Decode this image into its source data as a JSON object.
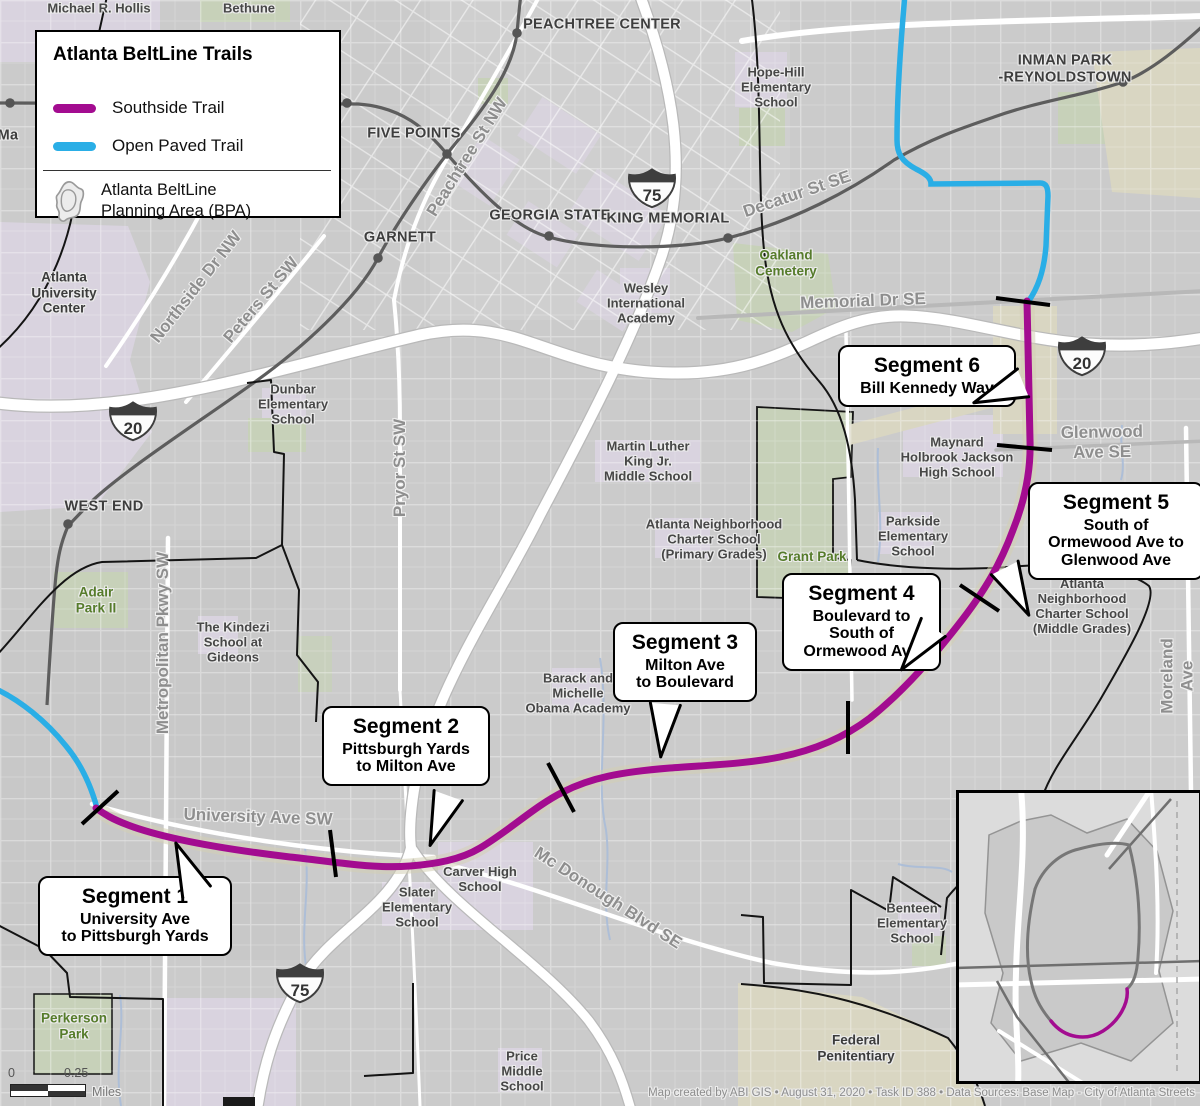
{
  "legend": {
    "title": "Atlanta BeltLine Trails",
    "items": [
      {
        "label": "Southside Trail",
        "color": "#a30c90"
      },
      {
        "label": "Open Paved Trail",
        "color": "#2aaee6"
      }
    ],
    "bpa_label": "Atlanta BeltLine\nPlanning Area (BPA)",
    "bpa_icon": "beltline-planning-area-outline-icon"
  },
  "callouts": [
    {
      "title": "Segment 1",
      "body": "University Ave\nto Pittsburgh Yards"
    },
    {
      "title": "Segment 2",
      "body": "Pittsburgh Yards\nto Milton Ave"
    },
    {
      "title": "Segment 3",
      "body": "Milton Ave\nto Boulevard"
    },
    {
      "title": "Segment 4",
      "body": "Boulevard to\nSouth of\nOrmewood Ave"
    },
    {
      "title": "Segment 5",
      "body": "South of\nOrmewood Ave to\nGlenwood Ave"
    },
    {
      "title": "Segment 6",
      "body": "Bill Kennedy Way"
    }
  ],
  "map": {
    "stations": [
      "PEACHTREE CENTER",
      "FIVE POINTS",
      "GEORGIA STATE",
      "KING MEMORIAL",
      "GARNETT",
      "WEST END",
      "INMAN PARK\n-REYNOLDSTOWN",
      "Ma"
    ],
    "roads": [
      "Peachtree St NW",
      "Northside Dr NW",
      "Peters St SW",
      "Pryor St SW",
      "Metropolitan Pkwy SW",
      "University Ave SW",
      "Mc Donough Blvd SE",
      "Memorial Dr SE",
      "Decatur St SE",
      "Glenwood Ave SE",
      "Moreland Ave"
    ],
    "schools": [
      "Michael R. Hollis",
      "Bethune",
      "Hope-Hill\nElementary\nSchool",
      "Wesley\nInternational\nAcademy",
      "Dunbar\nElementary\nSchool",
      "Martin Luther\nKing Jr.\nMiddle School",
      "Atlanta Neighborhood\nCharter School\n(Primary Grades)",
      "Maynard\nHolbrook Jackson\nHigh School",
      "Parkside\nElementary\nSchool",
      "Atlanta Neighborhood\nCharter School\n(Middle Grades)",
      "The Kindezi\nSchool at\nGideons",
      "Barack and\nMichelle\nObama Academy",
      "Carver High\nSchool",
      "Slater\nElementary\nSchool",
      "Benteen\nElementary\nSchool",
      "Price\nMiddle\nSchool"
    ],
    "parks": [
      "Oakland\nCemetery",
      "Grant Park",
      "Adair\nPark II",
      "Perkerson\nPark"
    ],
    "areas": [
      "Atlanta\nUniversity\nCenter",
      "Federal\nPenitentiary"
    ],
    "shields": [
      "75",
      "20",
      "20",
      "75"
    ],
    "trail_colors": {
      "southside": "#a30c90",
      "open_paved": "#2aaee6"
    }
  },
  "scalebar": {
    "zero": "0",
    "end": "0.25",
    "unit": "Miles"
  },
  "credits": "Map created by ABI GIS • August 31, 2020 • Task ID 388 • Data Sources: Base Map - City of Atlanta Streets"
}
